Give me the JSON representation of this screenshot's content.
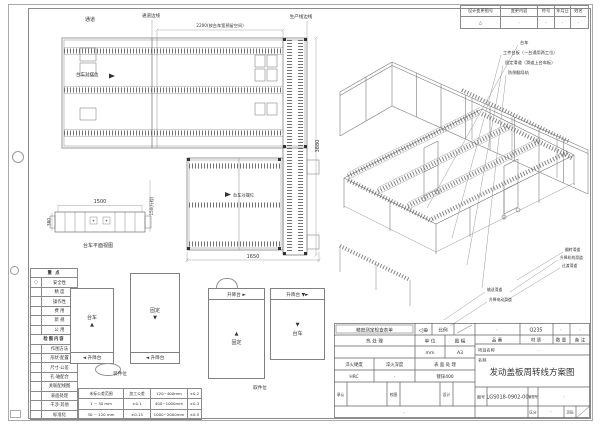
{
  "revision": {
    "headers": [
      "设计变更图号",
      "变更内容",
      "符号",
      "年月日",
      "姓名"
    ],
    "row": [
      "△",
      "·",
      "·",
      "·",
      "·"
    ]
  },
  "plan1": {
    "aisle": "通道",
    "aisle_edge": "通道边线",
    "prod_edge": "生产线边线",
    "dim_2200": "2200(按台车宽预留空间)",
    "trolley_label": "台车对摆位",
    "dim_3880": "3880"
  },
  "plan2": {
    "trolley_label": "台车对摆位",
    "dim_1650": "1650"
  },
  "side": {
    "dim_1500": "1500",
    "dim_380": "380",
    "dim_stroke": "150(行程)",
    "caption": "台车平面视图"
  },
  "iso": {
    "top": [
      "台车",
      "工件台板（一台通用两工位）",
      "固定滑道（滑道上台车板）",
      "防侧翻导轨"
    ],
    "right": [
      "翻转滑道",
      "升降机构滑道",
      "过渡滑道"
    ],
    "bottom": [
      "输送滑道",
      "升降电动滑道"
    ]
  },
  "checklist": {
    "rows": [
      {
        "mark": "",
        "label": "重 点"
      },
      {
        "mark": "○",
        "label": "安全性"
      },
      {
        "mark": "",
        "label": "精 度"
      },
      {
        "mark": "",
        "label": "操作性"
      },
      {
        "mark": "",
        "label": "费 用"
      },
      {
        "mark": "",
        "label": "新 规"
      },
      {
        "mark": "",
        "label": "公 用"
      },
      {
        "mark": "",
        "label": "检图内容"
      },
      {
        "mark": "",
        "label": "作图方法"
      },
      {
        "mark": "",
        "label": "形状·配置"
      },
      {
        "mark": "",
        "label": "尺寸·公差"
      },
      {
        "mark": "",
        "label": "孔·轴配合"
      },
      {
        "mark": "",
        "label": "关联配线图"
      },
      {
        "mark": "",
        "label": "表面处理"
      },
      {
        "mark": "",
        "label": "干涉·其他"
      },
      {
        "mark": "",
        "label": "标准化"
      }
    ]
  },
  "tolerance": {
    "rows": [
      [
        "未标公差范围",
        "加工公差",
        "120~400mm",
        "±0.2"
      ],
      [
        "1 ~ 30 mm",
        "±0.1",
        "400~1000mm",
        "±0.3"
      ],
      [
        "30 ~ 120 mm",
        "±0.15",
        "1000~2000mm",
        "±0.5"
      ]
    ]
  },
  "diagrams": {
    "a": {
      "label": "台车",
      "arrow": "▲",
      "bar": "◄ 升降台"
    },
    "b": {
      "label": "固定",
      "arrow": "▼",
      "bar": "◄ 升降台"
    },
    "c": {
      "label": "固定",
      "arrow": "▲",
      "bar": "升降台 ►"
    },
    "d": {
      "label": "台车",
      "arrow": "▼",
      "bar": "升降台 ▼►"
    },
    "caption_left": "装件位",
    "caption_right": "取件位"
  },
  "title_block": {
    "checklist_stamp": "精度测定检查表单",
    "projection_symbol": "◁⊕",
    "scale_label": "比例",
    "heat_treatment": "热 处 理",
    "unit_label": "单 位",
    "unit_value": "mm",
    "format_label": "图 幅",
    "format_value": "A3",
    "quench_hardness_label": "淬火硬度",
    "quench_hardness_value": "HRC",
    "quench_depth_label": "淬火深度",
    "quench_depth_value": "·",
    "surface_label": "表 面 处 理",
    "surface_value": "镀锌400",
    "approve_label": "承认",
    "check_label": "校图",
    "design_label": "设计",
    "bottom_dot": "·",
    "part_no_label": "品 番",
    "part_no_value": "·",
    "material_label": "材 质",
    "material_value": "Q235",
    "qty_label": "数 量",
    "qty_value": "·",
    "remark_label": "备 注",
    "remark_value": "·",
    "project_label": "项目名称",
    "project_value": "·",
    "name_label": "名称",
    "drawing_title": "发动盖板周转线方案图",
    "drawing_no_label": "图号",
    "drawing_no": "LGS018-0902-00",
    "mgmt_no_label": "管理号",
    "mgmt_no_value": "·",
    "division_label": "区分",
    "division_value": "·",
    "page_label": "页码"
  }
}
